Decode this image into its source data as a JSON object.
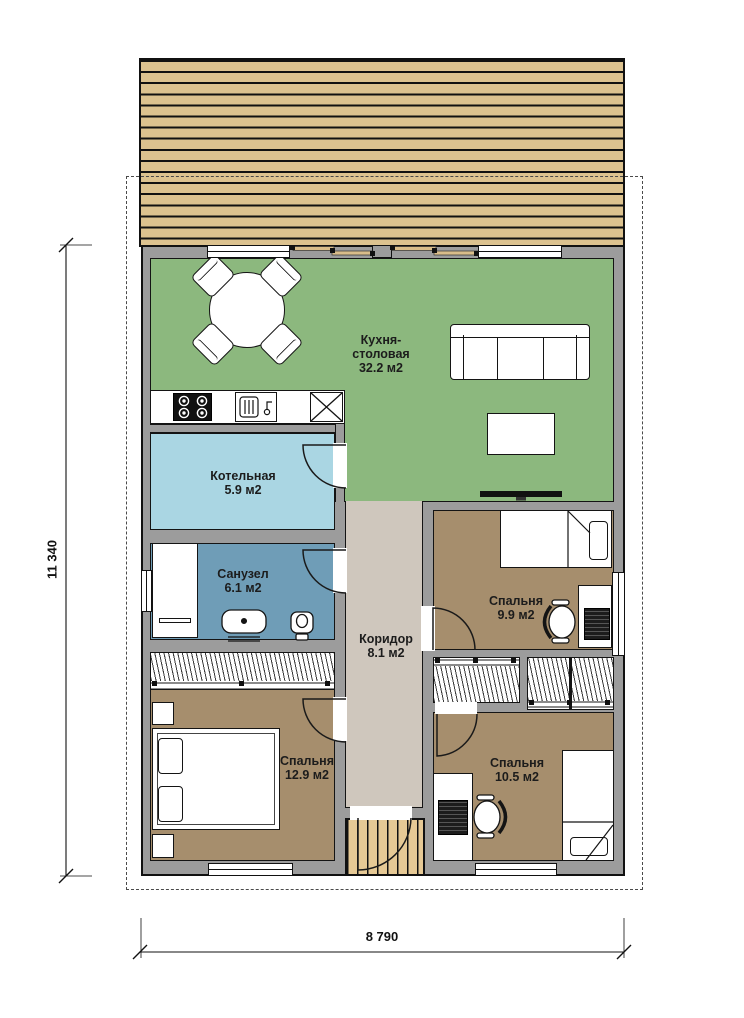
{
  "rooms": {
    "kitchen": {
      "line1": "Кухня-",
      "line2": "столовая",
      "area": "32.2 м2"
    },
    "boiler": {
      "name": "Котельная",
      "area": "5.9 м2"
    },
    "bathroom": {
      "name": "Санузел",
      "area": "6.1 м2"
    },
    "corridor": {
      "name": "Коридор",
      "area": "8.1 м2"
    },
    "bedroom_right_top": {
      "name": "Спальня",
      "area": "9.9 м2"
    },
    "bedroom_left": {
      "name": "Спальня",
      "area": "12.9 м2"
    },
    "bedroom_right_bottom": {
      "name": "Спальня",
      "area": "10.5 м2"
    }
  },
  "dimensions": {
    "height": "11 340",
    "width": "8 790"
  },
  "colors": {
    "paper": "#ffffff",
    "wall": "#9c9c9c",
    "kitchen": "#8cb87e",
    "boiler": "#aad6e3",
    "bathroom": "#6f9db7",
    "corridor": "#cfc7bd",
    "bedroom": "#a68e6d",
    "deck": "#dcc28f",
    "porch": "#e6c995"
  }
}
